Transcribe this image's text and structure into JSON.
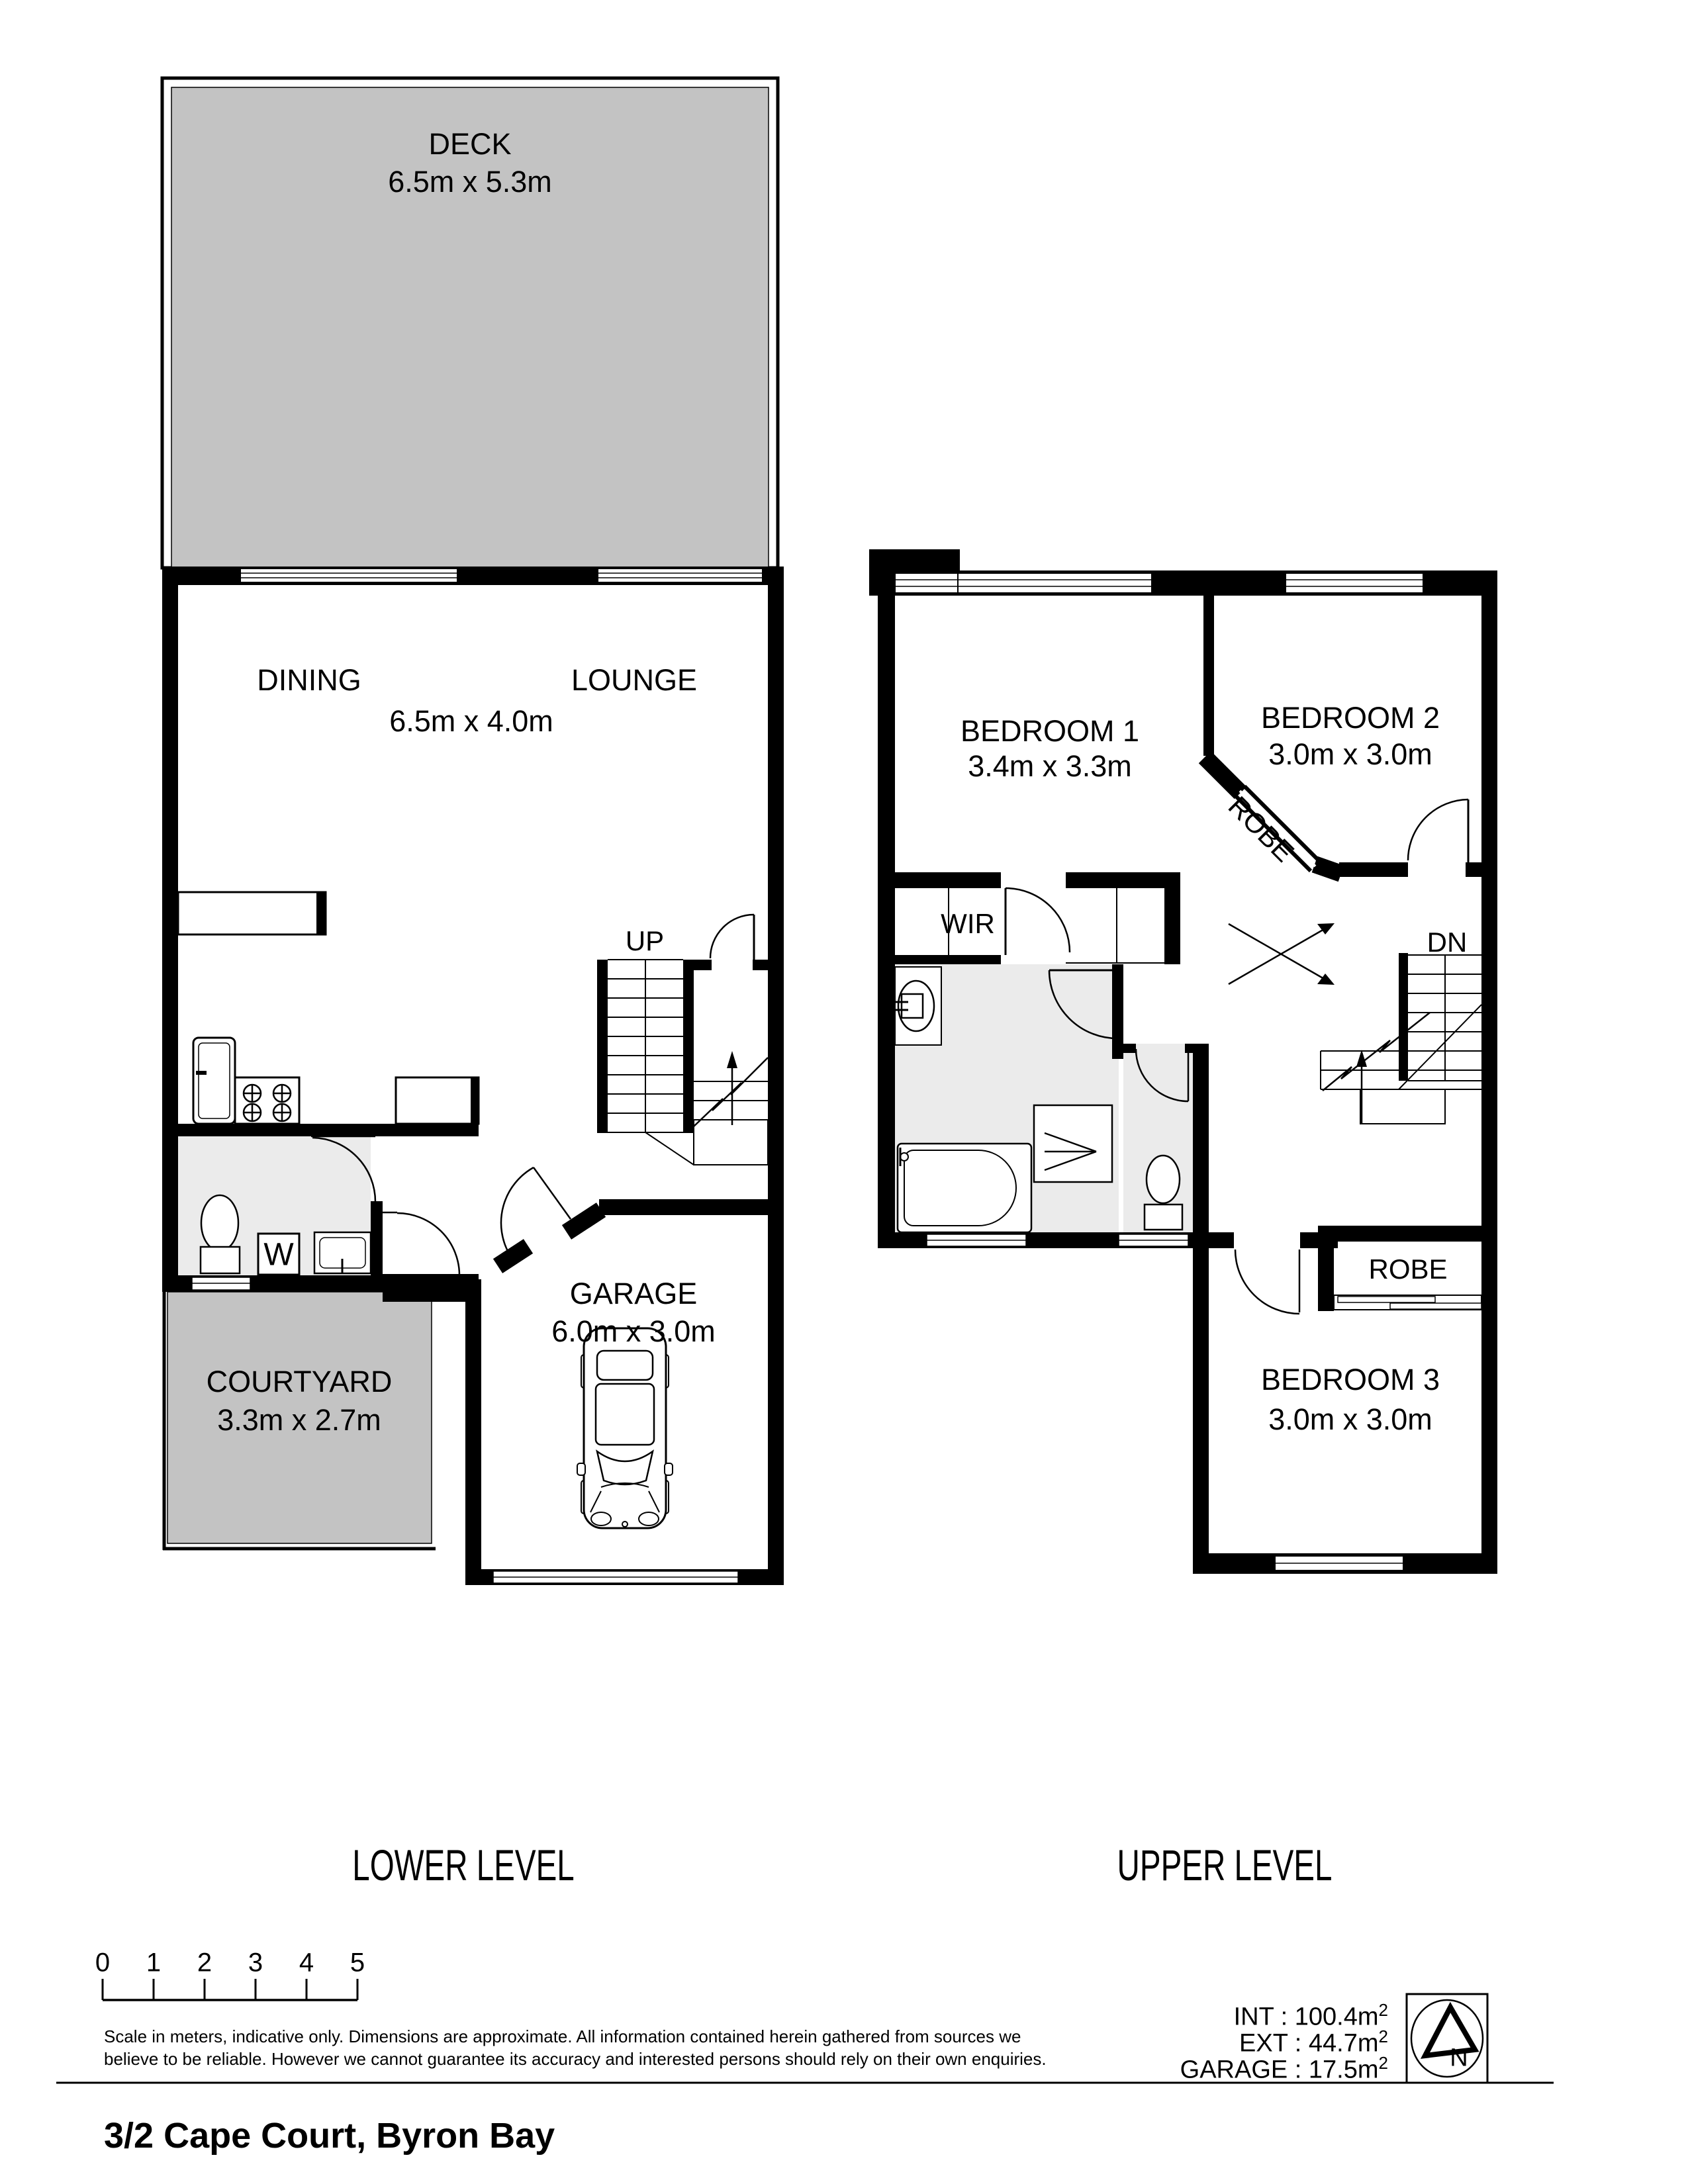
{
  "title": "3/2 Cape Court, Byron Bay",
  "levels": {
    "lower": "LOWER LEVEL",
    "upper": "UPPER LEVEL"
  },
  "lower": {
    "deck": {
      "name": "DECK",
      "dims": "6.5m x 5.3m"
    },
    "dining": "DINING",
    "lounge": "LOUNGE",
    "living_dims": "6.5m x 4.0m",
    "up": "UP",
    "w": "W",
    "garage": {
      "name": "GARAGE",
      "dims": "6.0m x 3.0m"
    },
    "courtyard": {
      "name": "COURTYARD",
      "dims": "3.3m x 2.7m"
    }
  },
  "upper": {
    "bedroom1": {
      "name": "BEDROOM 1",
      "dims": "3.4m x 3.3m"
    },
    "bedroom2": {
      "name": "BEDROOM 2",
      "dims": "3.0m x 3.0m"
    },
    "bedroom3": {
      "name": "BEDROOM 3",
      "dims": "3.0m x 3.0m"
    },
    "robe_diag": "ROBE",
    "robe": "ROBE",
    "wir": "WIR",
    "dn": "DN"
  },
  "scale_bar": {
    "ticks": [
      "0",
      "1",
      "2",
      "3",
      "4",
      "5"
    ]
  },
  "disclaimer": {
    "line1": "Scale in meters, indicative only. Dimensions are approximate. All information contained herein gathered from sources we",
    "line2": "believe to be reliable. However we cannot guarantee its accuracy and interested persons should rely on their own enquiries."
  },
  "areas": {
    "int_label": "INT : 100.4m",
    "ext_label": "EXT : 44.7m",
    "garage_label": "GARAGE : 17.5m",
    "sup": "2"
  },
  "north": {
    "label": "N"
  },
  "colors": {
    "wall": "#000000",
    "deck_fill": "#c3c3c3",
    "room_fill": "#ebebeb"
  }
}
